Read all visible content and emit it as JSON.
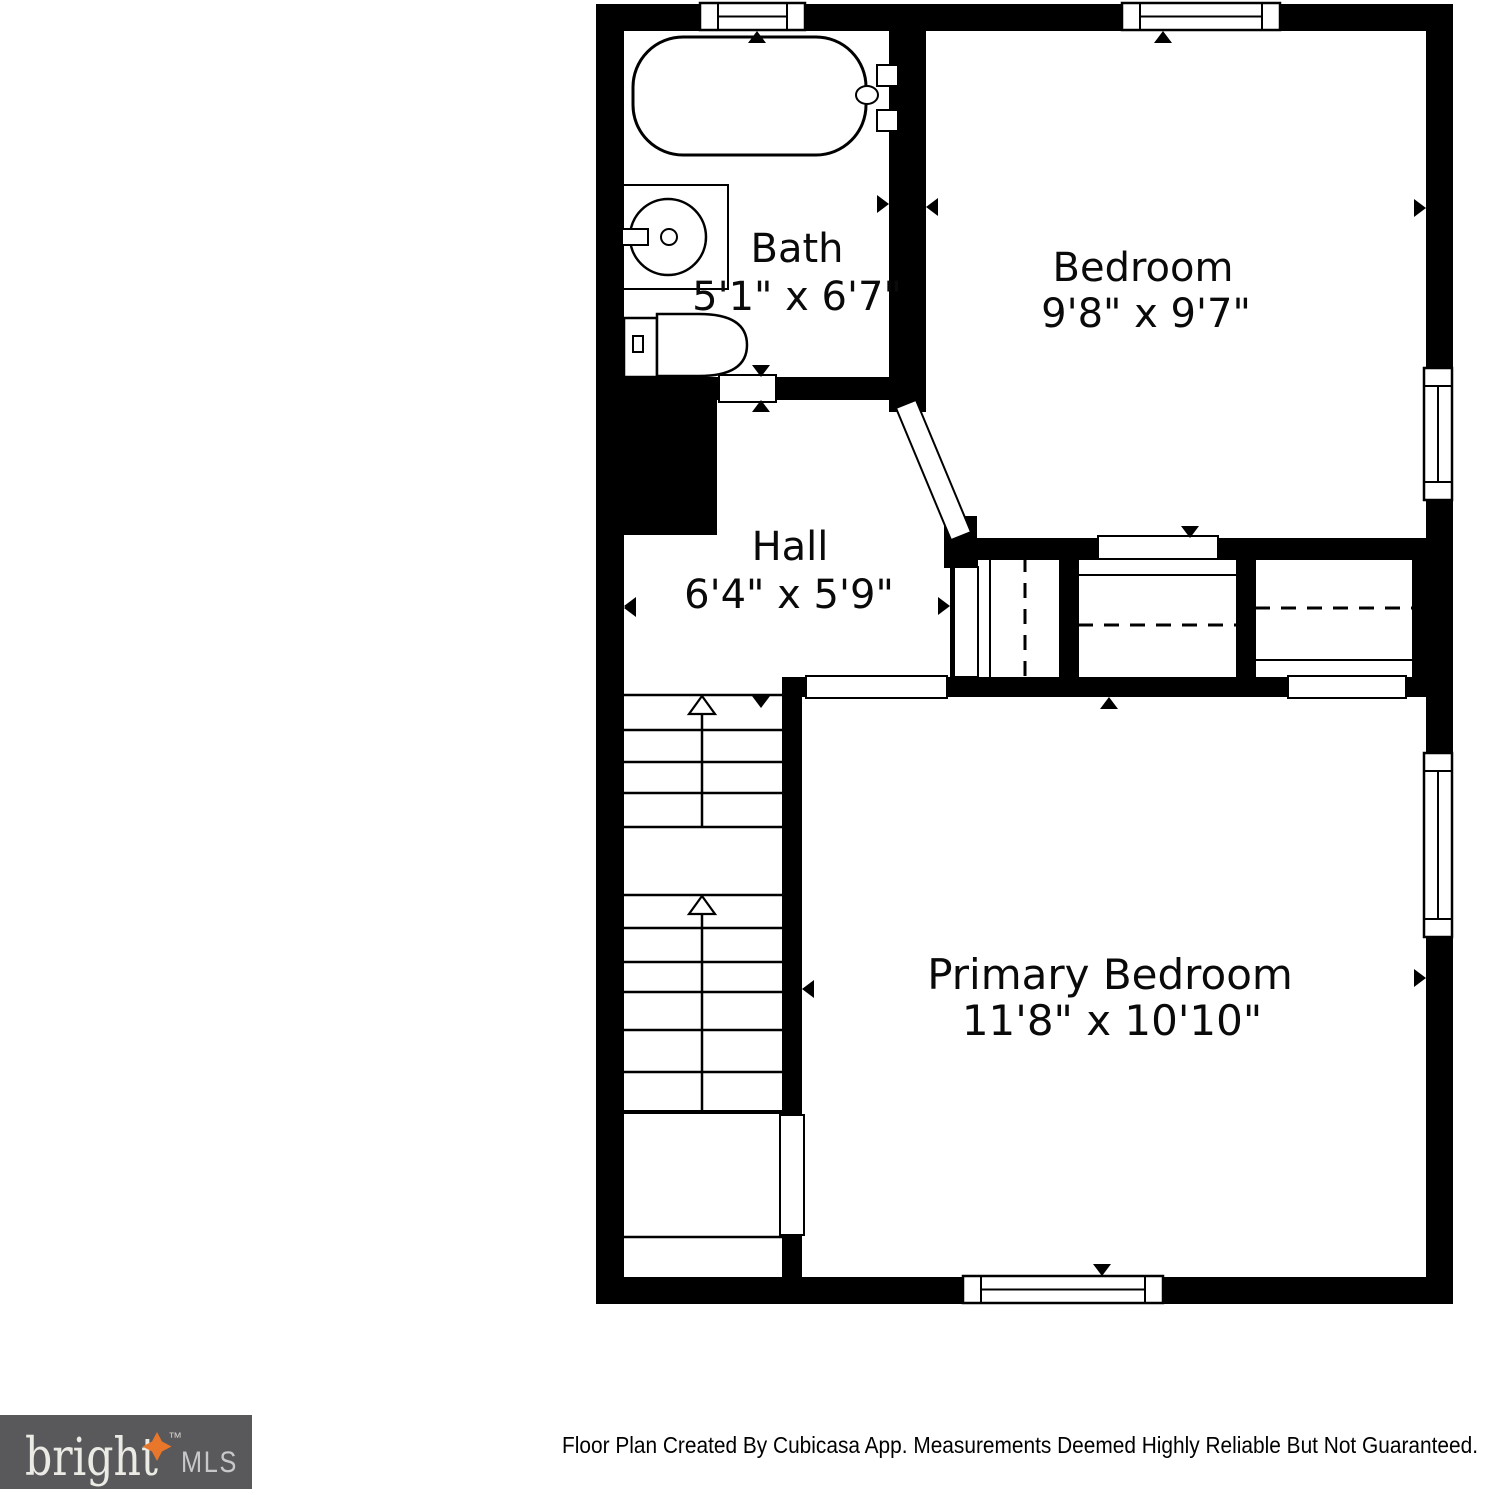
{
  "floor_plan": {
    "rooms": [
      {
        "name": "Bath",
        "dimensions": "5'1\" x 6'7\""
      },
      {
        "name": "Bedroom",
        "dimensions": "9'8\" x 9'7\""
      },
      {
        "name": "Hall",
        "dimensions": "6'4\" x 5'9\""
      },
      {
        "name": "Primary Bedroom",
        "dimensions": "11'8\" x 10'10\""
      }
    ],
    "fixtures": [
      "bathtub",
      "sink",
      "toilet",
      "staircase-up-arrows",
      "closet-hanging-rods"
    ],
    "colors": {
      "walls": "#000000",
      "floor": "#ffffff"
    }
  },
  "footer": {
    "disclaimer": "Floor Plan Created By Cubicasa App. Measurements Deemed Highly Reliable But Not Guaranteed."
  },
  "logo": {
    "brand": "bright",
    "trademark": "™",
    "suffix": "MLS",
    "background": "#59595b",
    "brand_color": "#eceae5",
    "accent": "#e8772b"
  }
}
